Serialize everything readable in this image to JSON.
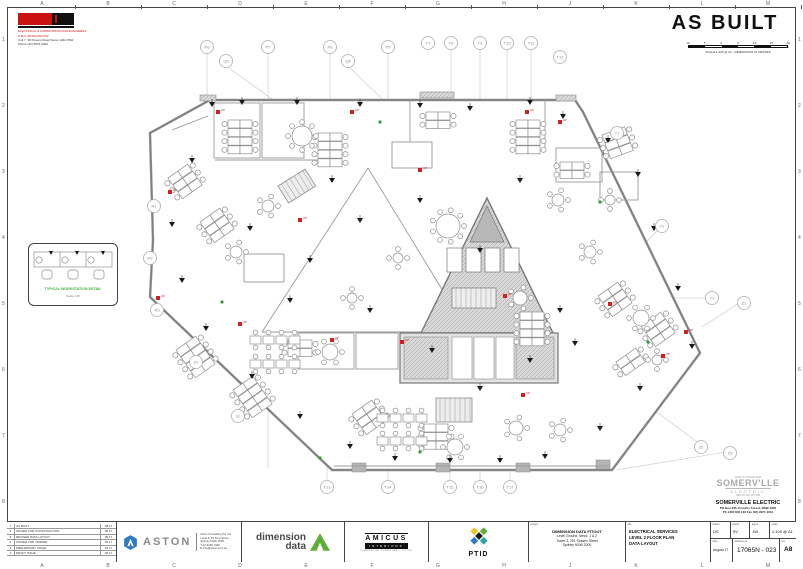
{
  "sheet": {
    "as_built": "AS BUILT",
    "frame_letters": [
      "A",
      "B",
      "C",
      "D",
      "E",
      "F",
      "G",
      "H",
      "J",
      "K",
      "L",
      "M"
    ],
    "frame_numbers": [
      "1",
      "2",
      "3",
      "4",
      "5",
      "6",
      "7",
      "8"
    ],
    "scale_ticks": [
      "10",
      "5",
      "0",
      "5",
      "10",
      "15",
      "20 m"
    ],
    "scale_caption": "SCALE 1:100 @ A1 - DIMENSIONS IN METRES"
  },
  "stamp": {
    "red_line1": "ELECTRICAL & COMMUNICATIONS ENGINEERS",
    "red_line2": "A.B.N. 98 000 000 000",
    "black_line1": "Unit 7, 38 Powers Road  Seven Hills NSW",
    "black_line2": "Phone (02) 9674 0000"
  },
  "detail_box": {
    "caption": "TYPICAL WORKSTATION DETAIL",
    "subcaption": "Scale 1:25"
  },
  "somerville": {
    "tag": "QUALITY SINCE 1945",
    "logo_top": "SOMERV'LLE",
    "logo_sub": "ELECTRIC",
    "abn": "ABN 60 000 423 188",
    "name": "SOMERVILLE ELECTRIC",
    "addr1": "PO Box 335, Frenchs Forest, NSW 1640",
    "addr2": "Ph 1300 843 133   Fax (02) 9971 4044"
  },
  "title_block": {
    "revisions": [
      [
        "7",
        "AS BUILT",
        "08.17"
      ],
      [
        "6",
        "ISSUED FOR CONSTRUCTION",
        "06.17"
      ],
      [
        "5",
        "REVISED DATA LAYOUT",
        "05.17"
      ],
      [
        "4",
        "ISSUED FOR TENDER",
        "04.17"
      ],
      [
        "3",
        "PRELIMINARY ISSUE",
        "03.17"
      ],
      [
        "2",
        "DRAFT ISSUE",
        "02.17"
      ]
    ],
    "aston": {
      "name": "ASTON",
      "firm": "Aston Consulting Pty Ltd",
      "addr1": "Level 5, 75 King Street",
      "addr2": "Sydney NSW 2000",
      "addr3": "T  02 9299 1900",
      "addr4": "E  info@aston.com.au"
    },
    "dimension_data": {
      "line1": "dimension",
      "line2": "data"
    },
    "amicus": {
      "name": "AMICUS",
      "sub": "INTERIORS",
      "tag": "COMMERCIAL FURNITURE + FITOUT"
    },
    "ptid": {
      "name": "PTID"
    },
    "project": {
      "label": "project",
      "line1": "DIMENSION DATA FITOUT",
      "line2": "Level Ground, Mezz, 1 & 2",
      "line3": "Tower 3, 201 Sussex Street",
      "line4": "Sydney NSW 2000"
    },
    "title": {
      "label": "title",
      "line1": "ELECTRICAL SERVICES",
      "line2": "LEVEL 2 FLOOR PLAN",
      "line3": "DATA LAYOUT"
    },
    "fields": {
      "drawn_label": "drawn",
      "drawn": "DS",
      "checked_label": "check",
      "checked": "SV",
      "approved_label": "app'd",
      "approved": "JW",
      "scale_label": "scale",
      "scale": "1:100 @ A1",
      "date_label": "date",
      "date": "August 17",
      "dwg_label": "drawing no.",
      "dwg_no": "17065N - 023",
      "rev_label": "rev",
      "rev": "A8"
    }
  },
  "floor_plan": {
    "outline": [
      [
        210,
        100
      ],
      [
        575,
        100
      ],
      [
        583,
        112
      ],
      [
        700,
        353
      ],
      [
        612,
        470
      ],
      [
        332,
        470
      ],
      [
        150,
        297
      ],
      [
        153,
        240
      ],
      [
        150,
        133
      ]
    ],
    "grid_lines": [
      [
        207,
        53,
        207,
        98
      ],
      [
        268,
        53,
        268,
        468
      ],
      [
        330,
        53,
        330,
        468
      ],
      [
        388,
        53,
        388,
        468
      ],
      [
        451,
        49,
        451,
        462
      ],
      [
        480,
        49,
        480,
        478
      ],
      [
        507,
        49,
        507,
        455
      ],
      [
        531,
        49,
        531,
        430
      ],
      [
        226,
        66,
        368,
        168
      ],
      [
        348,
        66,
        468,
        182
      ],
      [
        612,
        138,
        492,
        330
      ],
      [
        658,
        230,
        540,
        352
      ],
      [
        707,
        298,
        565,
        298
      ],
      [
        739,
        303,
        702,
        327
      ],
      [
        697,
        442,
        630,
        392
      ],
      [
        726,
        452,
        616,
        470
      ],
      [
        327,
        480,
        327,
        445
      ],
      [
        388,
        480,
        388,
        445
      ],
      [
        450,
        480,
        450,
        432
      ],
      [
        480,
        480,
        480,
        432
      ],
      [
        510,
        480,
        510,
        432
      ],
      [
        160,
        210,
        176,
        213
      ],
      [
        156,
        258,
        174,
        258
      ],
      [
        163,
        308,
        182,
        300
      ],
      [
        201,
        360,
        216,
        352
      ],
      [
        243,
        414,
        256,
        404
      ]
    ],
    "grid_bubbles": [
      [
        "P6",
        207,
        47
      ],
      [
        "Q5",
        226,
        61
      ],
      [
        "P7",
        268,
        47
      ],
      [
        "P8",
        330,
        47
      ],
      [
        "Q6",
        348,
        61
      ],
      [
        "P9",
        388,
        47
      ],
      [
        "T7",
        428,
        43
      ],
      [
        "T8",
        451,
        43
      ],
      [
        "T9",
        480,
        43
      ],
      [
        "T10",
        507,
        43
      ],
      [
        "T11",
        531,
        43
      ],
      [
        "T12",
        560,
        57
      ],
      [
        "Y1",
        617,
        133
      ],
      [
        "Y2",
        662,
        226
      ],
      [
        "Y3",
        712,
        298
      ],
      [
        "Z1",
        744,
        303
      ],
      [
        "Z2",
        701,
        447
      ],
      [
        "Z3",
        730,
        453
      ],
      [
        "T13",
        327,
        487
      ],
      [
        "T14",
        388,
        487
      ],
      [
        "T15",
        450,
        487
      ],
      [
        "T16",
        480,
        487
      ],
      [
        "T17",
        510,
        487
      ],
      [
        "R1",
        154,
        206
      ],
      [
        "R2",
        150,
        258
      ],
      [
        "R3",
        157,
        310
      ],
      [
        "S1",
        196,
        362
      ],
      [
        "S2",
        238,
        416
      ]
    ],
    "rooms": [
      [
        214,
        103,
        46,
        55
      ],
      [
        262,
        103,
        42,
        55
      ],
      [
        556,
        148,
        46,
        34
      ],
      [
        298,
        333,
        56,
        36
      ],
      [
        356,
        333,
        42,
        36
      ],
      [
        244,
        254,
        40,
        28
      ],
      [
        600,
        172,
        38,
        28
      ],
      [
        392,
        142,
        40,
        26
      ]
    ],
    "partitions": [
      [
        215,
        160,
        330,
        160
      ],
      [
        410,
        100,
        410,
        142
      ],
      [
        545,
        100,
        545,
        148
      ],
      [
        368,
        168,
        262,
        332
      ],
      [
        368,
        168,
        468,
        332
      ],
      [
        262,
        332,
        421,
        332
      ],
      [
        172,
        130,
        208,
        116
      ],
      [
        334,
        466,
        610,
        466
      ]
    ],
    "core_triangle": [
      [
        487,
        198
      ],
      [
        553,
        333
      ],
      [
        421,
        333
      ]
    ],
    "core_apex": [
      [
        487,
        206
      ],
      [
        504,
        242
      ],
      [
        470,
        242
      ]
    ],
    "core_lifts": [
      [
        447,
        248,
        15,
        24
      ],
      [
        466,
        248,
        15,
        24
      ],
      [
        485,
        248,
        15,
        24
      ],
      [
        504,
        248,
        15,
        24
      ]
    ],
    "core_stair": [
      452,
      288,
      44,
      20
    ],
    "core_block": [
      400,
      333,
      158,
      50
    ],
    "core_block_hatch": [
      [
        404,
        337,
        44,
        42
      ],
      [
        516,
        337,
        38,
        42
      ]
    ],
    "core_block_rooms": [
      [
        452,
        337,
        20,
        42
      ],
      [
        474,
        337,
        20,
        42
      ],
      [
        496,
        337,
        18,
        42
      ]
    ],
    "stairs": [
      [
        278,
        186,
        32,
        20,
        -32
      ],
      [
        436,
        398,
        36,
        24,
        0
      ]
    ],
    "desk_clusters": [
      [
        228,
        120,
        4,
        0
      ],
      [
        318,
        133,
        4,
        0
      ],
      [
        516,
        120,
        4,
        0
      ],
      [
        560,
        162,
        2,
        0
      ],
      [
        602,
        135,
        3,
        -20
      ],
      [
        168,
        178,
        3,
        -35
      ],
      [
        200,
        222,
        3,
        -35
      ],
      [
        598,
        296,
        3,
        -35
      ],
      [
        641,
        326,
        3,
        -35
      ],
      [
        616,
        362,
        2,
        -35
      ],
      [
        176,
        350,
        4,
        -35
      ],
      [
        233,
        390,
        4,
        -35
      ],
      [
        520,
        312,
        4,
        0
      ],
      [
        424,
        424,
        3,
        0
      ],
      [
        352,
        414,
        3,
        -35
      ],
      [
        288,
        340,
        2,
        0
      ],
      [
        426,
        112,
        2,
        0
      ]
    ],
    "bench_rows": [
      [
        250,
        336,
        4
      ],
      [
        250,
        360,
        4
      ],
      [
        377,
        414,
        4
      ],
      [
        377,
        437,
        4
      ]
    ],
    "round_tables": [
      [
        302,
        136,
        10,
        8
      ],
      [
        448,
        226,
        12,
        9
      ],
      [
        268,
        206,
        6,
        5
      ],
      [
        236,
        252,
        6,
        5
      ],
      [
        330,
        352,
        8,
        6
      ],
      [
        520,
        298,
        7,
        5
      ],
      [
        641,
        318,
        8,
        6
      ],
      [
        657,
        360,
        5,
        4
      ],
      [
        455,
        447,
        8,
        6
      ],
      [
        516,
        428,
        7,
        5
      ],
      [
        558,
        200,
        6,
        5
      ],
      [
        590,
        252,
        6,
        5
      ],
      [
        560,
        430,
        6,
        5
      ],
      [
        352,
        298,
        5,
        4
      ],
      [
        398,
        258,
        5,
        4
      ],
      [
        610,
        200,
        5,
        4
      ]
    ],
    "black_markers": [
      [
        212,
        106
      ],
      [
        242,
        104
      ],
      [
        297,
        104
      ],
      [
        360,
        106
      ],
      [
        420,
        107
      ],
      [
        470,
        110
      ],
      [
        530,
        104
      ],
      [
        563,
        118
      ],
      [
        608,
        142
      ],
      [
        638,
        176
      ],
      [
        654,
        230
      ],
      [
        678,
        290
      ],
      [
        692,
        348
      ],
      [
        640,
        390
      ],
      [
        600,
        430
      ],
      [
        545,
        458
      ],
      [
        500,
        462
      ],
      [
        450,
        462
      ],
      [
        395,
        460
      ],
      [
        350,
        448
      ],
      [
        300,
        418
      ],
      [
        252,
        378
      ],
      [
        206,
        330
      ],
      [
        182,
        282
      ],
      [
        172,
        226
      ],
      [
        192,
        162
      ],
      [
        250,
        230
      ],
      [
        310,
        262
      ],
      [
        370,
        312
      ],
      [
        432,
        352
      ],
      [
        480,
        390
      ],
      [
        530,
        362
      ],
      [
        560,
        312
      ],
      [
        480,
        252
      ],
      [
        420,
        202
      ],
      [
        360,
        222
      ],
      [
        332,
        182
      ],
      [
        290,
        302
      ],
      [
        520,
        182
      ],
      [
        575,
        345
      ]
    ],
    "red_markers": [
      [
        218,
        112
      ],
      [
        352,
        112
      ],
      [
        527,
        112
      ],
      [
        170,
        192
      ],
      [
        158,
        298
      ],
      [
        240,
        324
      ],
      [
        332,
        340
      ],
      [
        402,
        342
      ],
      [
        523,
        395
      ],
      [
        610,
        304
      ],
      [
        663,
        356
      ],
      [
        505,
        296
      ],
      [
        420,
        170
      ],
      [
        300,
        220
      ],
      [
        560,
        122
      ],
      [
        686,
        332
      ]
    ],
    "red_label": "AP",
    "green_dots": [
      [
        320,
        458
      ],
      [
        420,
        452
      ],
      [
        222,
        302
      ],
      [
        600,
        202
      ],
      [
        648,
        342
      ],
      [
        380,
        122
      ]
    ],
    "col_stubs": [
      [
        352,
        463
      ],
      [
        436,
        463
      ],
      [
        516,
        463
      ],
      [
        596,
        460
      ]
    ],
    "top_hatch": [
      [
        200,
        95,
        16
      ],
      [
        420,
        92,
        34
      ],
      [
        556,
        95,
        20
      ]
    ]
  }
}
